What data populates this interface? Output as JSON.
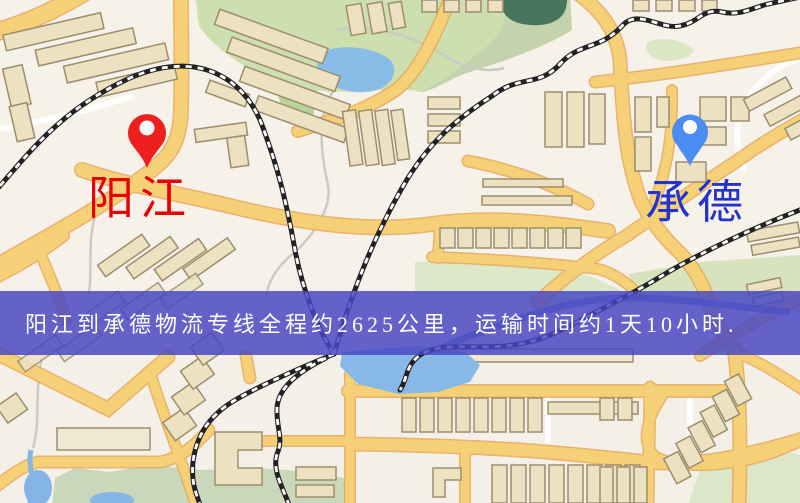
{
  "banner": {
    "text": "阳江到承德物流专线全程约2625公里，运输时间约1天10小时.",
    "bg_color": "#4846c3",
    "text_color": "#ffffff",
    "route_distance_km": "2625",
    "route_duration": "1天10小时"
  },
  "markers": {
    "origin": {
      "label": "阳江",
      "pin_color": "#ee1f1f",
      "label_color": "#e60000"
    },
    "destination": {
      "label": "承德",
      "pin_color": "#4b8cf2",
      "label_color": "#2433cc"
    }
  },
  "map_palette": {
    "background": "#f5f0e7",
    "road_fill": "#f6d077",
    "road_casing": "#e7a85a",
    "minor_road": "#ffffff",
    "building_fill": "#ece1c1",
    "building_stroke": "#9b8d6d",
    "park_green": "#cddfae",
    "park_muted": "#c9d8ba",
    "water_blue": "#88b8e6",
    "dark_pond": "#47755c",
    "railway": "#222222"
  }
}
